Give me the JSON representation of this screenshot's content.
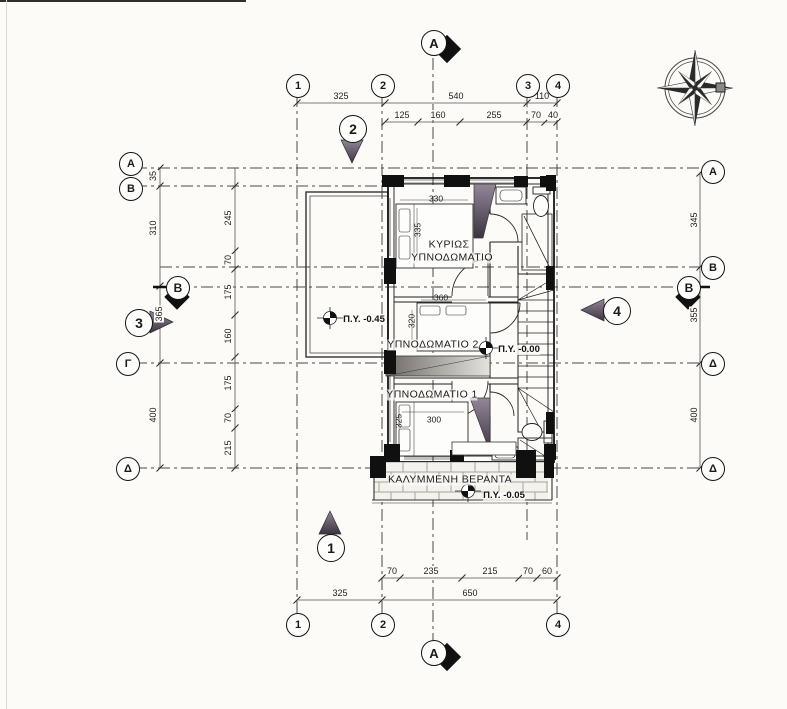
{
  "drawing": {
    "type": "architectural-floor-plan",
    "grid": {
      "top": [
        "1",
        "2",
        "3",
        "4"
      ],
      "bottom": [
        "1",
        "2",
        "4"
      ],
      "left": [
        "A",
        "B",
        "Γ",
        "Δ"
      ],
      "right": [
        "A",
        "B",
        "Δ",
        "Δ"
      ]
    },
    "sections": {
      "a": "A",
      "s1": "1",
      "s2": "2",
      "s3": "3",
      "s4": "4",
      "b": "B"
    },
    "dims": {
      "top1": [
        "325",
        "540",
        "110"
      ],
      "top2": [
        "125",
        "160",
        "255",
        "70",
        "40"
      ],
      "bottom_upper": [
        "70",
        "235",
        "215",
        "70",
        "60"
      ],
      "bottom_lower": [
        "325",
        "650"
      ],
      "left_outer": [
        "35",
        "310",
        "365",
        "400"
      ],
      "left_inner": [
        "245",
        "70",
        "175",
        "160",
        "175",
        "70",
        "215"
      ],
      "right": [
        "345",
        "355",
        "400"
      ]
    },
    "rooms": {
      "master_line1": "ΚΥΡΙΩΣ",
      "master_line2": "ΥΠΝΟΔΩΜΑΤΙΟ",
      "bedroom2": "ΥΠΝΟΔΩΜΑΤΙΟ 2",
      "bedroom1": "ΥΠΝΟΔΩΜΑΤΙΟ 1",
      "veranda": "ΚΑΛΥΜΜΕΝΗ ΒΕΡΑΝΤΑ"
    },
    "levels": {
      "terrace": "Π.Υ. -0.45",
      "hall": "Π.Υ. -0.00",
      "veranda": "Π.Υ. -0.05"
    },
    "furniture_dims": {
      "master_w": "330",
      "master_h": "335",
      "bed2_w": "360",
      "bed2_h": "320",
      "bed1_w": "300",
      "bed1_h": "325"
    },
    "colors": {
      "line": "#1d1d1d",
      "dash": "#4a4a4a",
      "marker_dark": "#473d4a",
      "paper": "#fcfbf8"
    }
  }
}
